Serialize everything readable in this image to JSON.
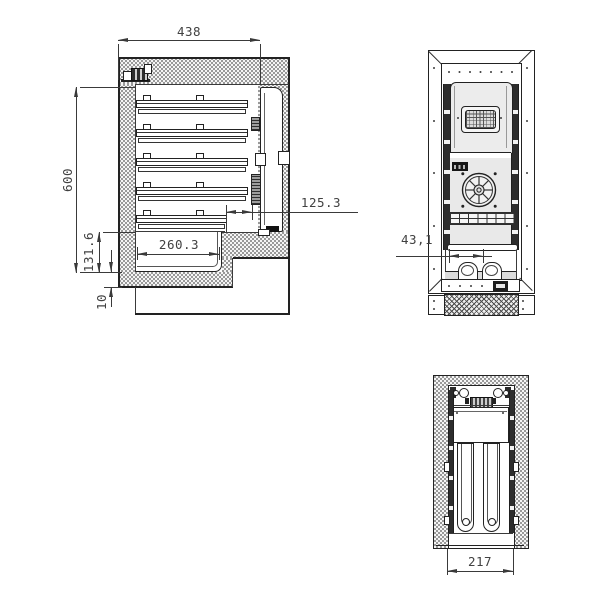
{
  "drawing": {
    "side_view": {
      "top_width": "438",
      "left_height": "600",
      "recess_height": "131.6",
      "bottom_thickness": "10",
      "inner_width": "260.3",
      "right_offset": "125.3"
    },
    "rear_view": {
      "pipe_pitch": "43,1"
    },
    "bottom_view": {
      "width": "217"
    },
    "colors": {
      "line": "#2b2b2b",
      "dim_text": "#414141",
      "hatch_dot": "#878787",
      "panel_fill": "#ececec"
    }
  }
}
